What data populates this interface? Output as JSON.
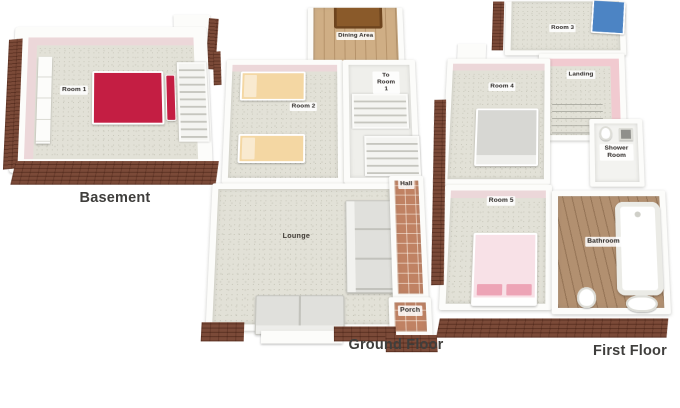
{
  "floors": {
    "basement": {
      "caption": "Basement",
      "rooms": {
        "room1": "Room 1"
      }
    },
    "ground": {
      "caption": "Ground Floor",
      "rooms": {
        "dining": "Dining Area",
        "to_room1": "To Room 1",
        "room2": "Room 2",
        "lounge": "Lounge",
        "hall": "Hall",
        "porch": "Porch"
      }
    },
    "first": {
      "caption": "First Floor",
      "rooms": {
        "room3": "Room 3",
        "room4": "Room 4",
        "landing": "Landing",
        "shower": "Shower Room",
        "room5": "Room 5",
        "bathroom": "Bathroom"
      }
    }
  },
  "colors": {
    "background": "#ffffff",
    "wall_white": "#fcfcfa",
    "floor_speckle": "#e2e1d7",
    "accent_wall_pink": "#ecd7d9",
    "accent_wall_pink_strong": "#f1cad0",
    "brick_base": "#7b4a38",
    "wood_dining": "#cfae85",
    "wood_bathroom": "#b29070",
    "tile_terracotta": "#c08263",
    "bed_red": "#c41e43",
    "bed_tan": "#f4d7a3",
    "bed_gray": "#d7d7d3",
    "bed_pink": "#f8e1e7",
    "bed_blue": "#4c84c4",
    "sofa_gray": "#e0e0dc",
    "dining_table": "#8a5a2a",
    "caption_text": "#3f3e3c"
  }
}
